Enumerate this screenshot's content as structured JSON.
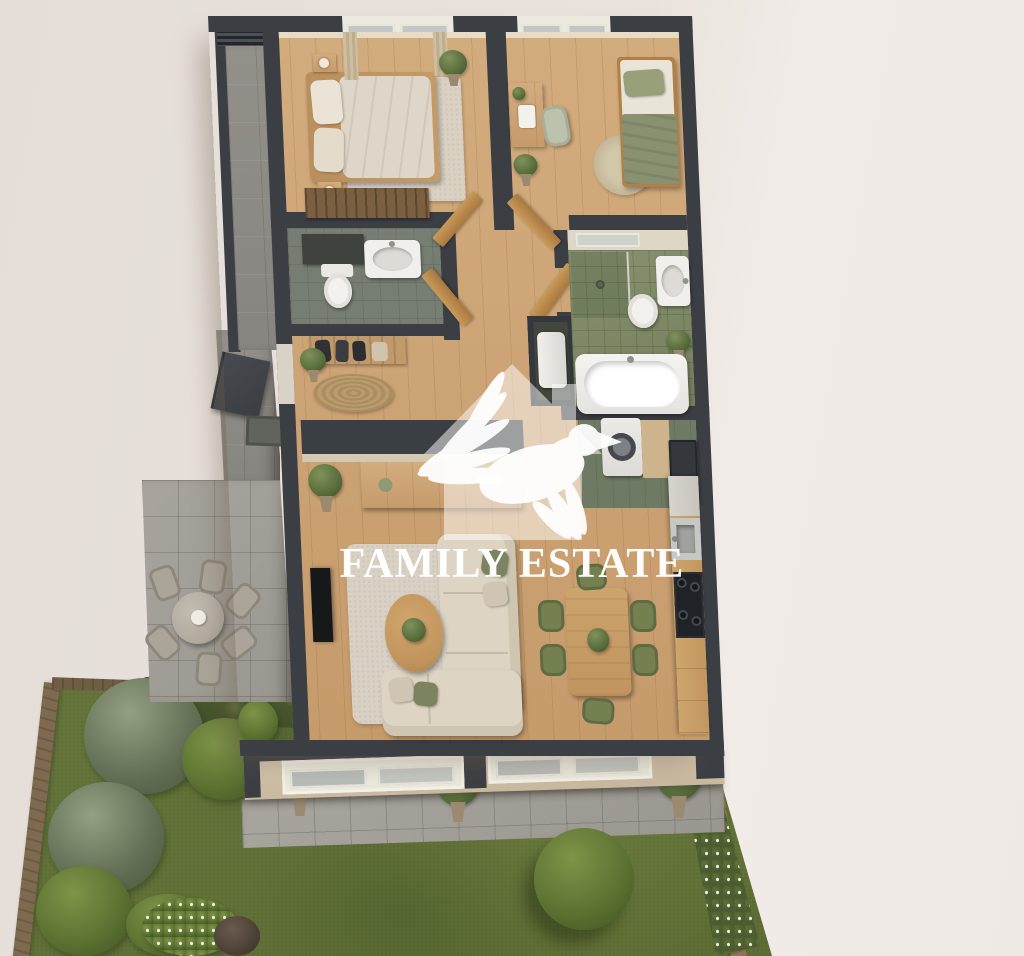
{
  "watermark": {
    "brand_name": "FAMILY ESTATE",
    "logo": "house-with-dove-icon",
    "color": "#ffffff"
  },
  "palette": {
    "background": "#e9e2dc",
    "walls": "#3b3e43",
    "wood_floor": "#cda57a",
    "bathroom_tile_green": "#7d8767",
    "lawn_green": "#68773a",
    "olive_accent": "#74804f",
    "terrace_stone": "#a19f99",
    "fence_wood": "#8b7354"
  },
  "floor_plan": {
    "view": "top-down-3d-render",
    "rooms": [
      {
        "id": "bedroom-1",
        "furniture": [
          "double-bed",
          "nightstands",
          "rug",
          "wardrobe",
          "plant",
          "curtains"
        ]
      },
      {
        "id": "bedroom-2",
        "furniture": [
          "single-bed",
          "desk",
          "chair",
          "round-rug",
          "plants"
        ]
      },
      {
        "id": "bathroom-1",
        "furniture": [
          "vanity",
          "sink",
          "toilet"
        ]
      },
      {
        "id": "bathroom-2",
        "furniture": [
          "shower",
          "sink",
          "toilet",
          "bathtub",
          "plant"
        ]
      },
      {
        "id": "entry-hall",
        "furniture": [
          "coat-rack",
          "round-rug",
          "plant",
          "front-door"
        ]
      },
      {
        "id": "utility",
        "furniture": [
          "washing-machine",
          "boiler",
          "tall-cabinet"
        ]
      },
      {
        "id": "living-room",
        "furniture": [
          "corner-sofa",
          "coffee-table",
          "rug",
          "tv",
          "sideboard",
          "plant"
        ]
      },
      {
        "id": "dining-area",
        "furniture": [
          "table",
          "six-chairs",
          "plant"
        ]
      },
      {
        "id": "kitchen",
        "furniture": [
          "counter",
          "sink",
          "cooktop",
          "cabinets",
          "fridge"
        ]
      },
      {
        "id": "balcony",
        "furniture": [
          "stone-tiles",
          "ac-grill"
        ]
      },
      {
        "id": "terrace",
        "furniture": [
          "outdoor-table",
          "outdoor-chairs",
          "door-mat"
        ]
      },
      {
        "id": "garden",
        "furniture": [
          "lawn",
          "hedge",
          "bushes",
          "flower-bed",
          "fences",
          "paved-patio",
          "potted-plants",
          "tree"
        ]
      }
    ]
  }
}
